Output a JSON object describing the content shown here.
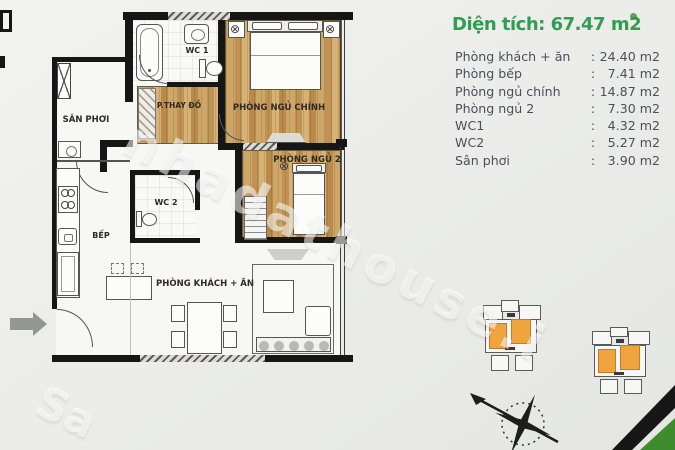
{
  "panel": {
    "title": "Diện tích: 67.47 m2",
    "rows": [
      {
        "label": "Phòng khách + ăn",
        "sep": ":",
        "value": "24.40 m2"
      },
      {
        "label": "Phòng bếp",
        "sep": ":",
        "value": "7.41 m2"
      },
      {
        "label": "Phòng ngủ chính",
        "sep": ":",
        "value": "14.87 m2"
      },
      {
        "label": "Phòng ngủ 2",
        "sep": ":",
        "value": "7.30 m2"
      },
      {
        "label": "WC1",
        "sep": ":",
        "value": "4.32 m2"
      },
      {
        "label": "WC2",
        "sep": ":",
        "value": "5.27 m2"
      },
      {
        "label": "Sân phơi",
        "sep": ":",
        "value": "3.90 m2"
      }
    ]
  },
  "plan": {
    "labels": {
      "san_phoi": "SÂN PHƠI",
      "wc1": "WC 1",
      "p_thay_do": "P.THAY ĐỒ",
      "ngu_chinh": "PHÒNG NGỦ CHÍNH",
      "wc2": "WC 2",
      "ngu_2": "PHÒNG NGỦ 2",
      "bep": "BẾP",
      "khach_an": "PHÒNG KHÁCH + ĂN"
    },
    "watermark_main": "nhadathouse.i",
    "watermark_corner": "Sa"
  },
  "colors": {
    "accent-green": "#2f9e51",
    "list-text": "#46515c",
    "unit-orange": "#f0a440",
    "corner-green": "#3f8c2f",
    "wall-black": "#161616"
  }
}
